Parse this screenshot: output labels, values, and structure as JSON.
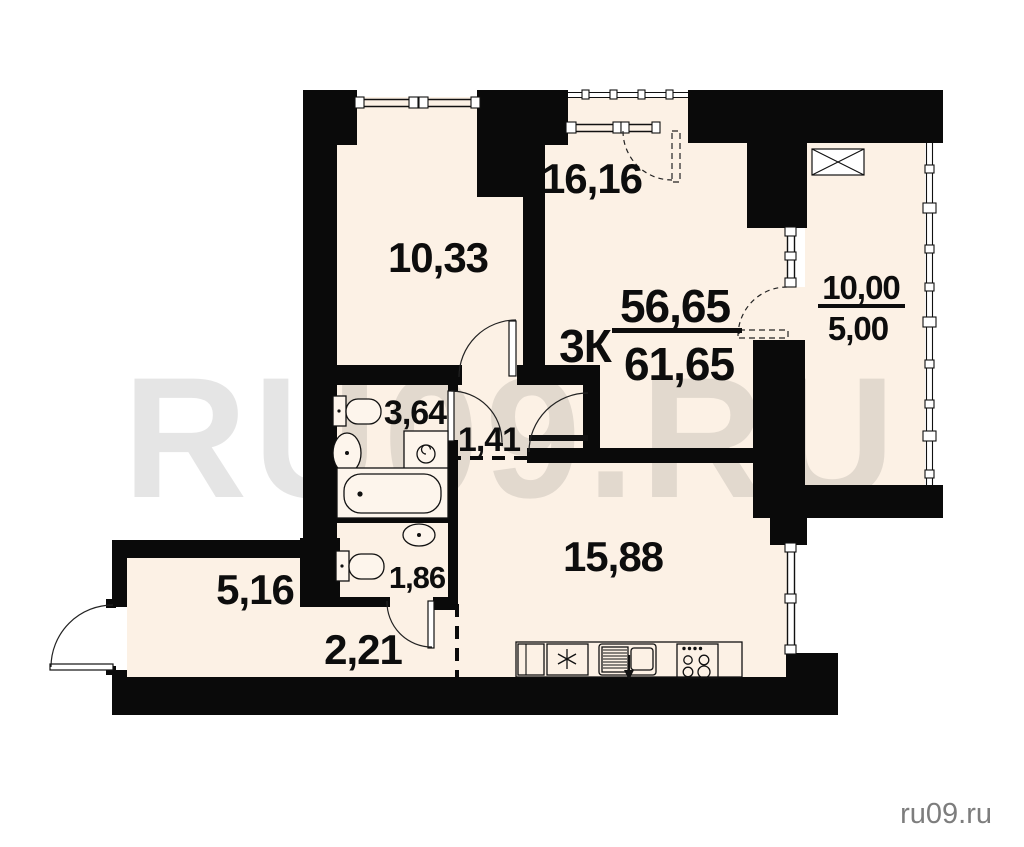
{
  "watermark": {
    "text": "RU09.RU"
  },
  "credit": {
    "text": "ru09.ru"
  },
  "apartment": {
    "type": "3К",
    "area_living": "56,65",
    "area_total": "61,65"
  },
  "rooms": {
    "bedroom": {
      "area": "10,33"
    },
    "living": {
      "area": "16,16"
    },
    "kitchen": {
      "area": "15,88"
    },
    "bathroom": {
      "area": "3,64"
    },
    "corridor": {
      "area": "1,41"
    },
    "wc": {
      "area": "1,86"
    },
    "hallway": {
      "area": "2,21"
    },
    "entry_hall": {
      "area": "5,16"
    }
  },
  "balcony": {
    "area_full": "10,00",
    "area_counted": "5,00"
  },
  "colors": {
    "floor": "#fcf1e5",
    "wall": "#0a0a0a",
    "watermark_gray": "#4a4a4a",
    "credit_gray": "#7d7d7d"
  }
}
